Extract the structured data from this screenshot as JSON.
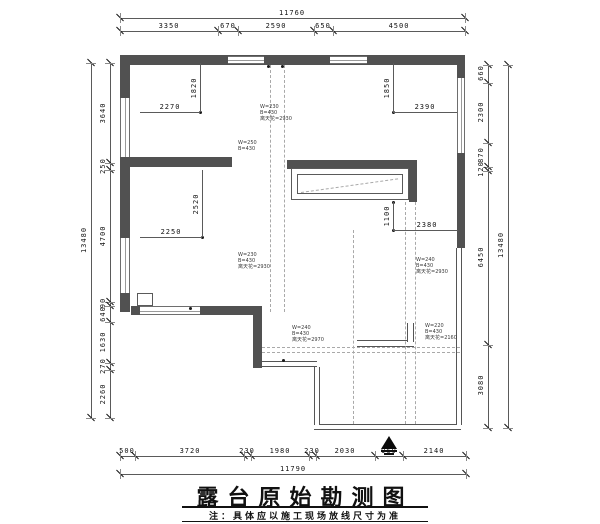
{
  "title": {
    "text": "露台原始勘测图",
    "note": "注：具体应以施工现场放线尺寸为准"
  },
  "drawing": {
    "dimension_chains": {
      "top": {
        "total": "11760",
        "segments": [
          "3350",
          "670",
          "2590",
          "650",
          "4500"
        ]
      },
      "bottom": {
        "total": "11790",
        "segments": [
          "500",
          "3720",
          "230",
          "1980",
          "230",
          "2030",
          "960",
          "2140"
        ]
      },
      "left": {
        "total": "13480",
        "segments": [
          "3640",
          "250",
          "4700",
          "90",
          "640",
          "1630",
          "270",
          "2260"
        ]
      },
      "right": {
        "total": "13480",
        "segments": [
          "660",
          "2300",
          "870",
          "120",
          "6450",
          "3080"
        ]
      }
    },
    "strips": [
      {
        "n": "dim-top-total",
        "dir": "h",
        "pos": 18,
        "from": 120,
        "to": 465,
        "ticks": [
          120,
          465
        ],
        "labels": [
          {
            "t": "11760",
            "c": 292
          }
        ]
      },
      {
        "n": "dim-top-segments",
        "dir": "h",
        "pos": 31,
        "from": 120,
        "to": 465,
        "ticks": [
          120,
          218,
          238,
          314,
          333,
          465
        ],
        "labels": [
          {
            "t": "3350",
            "c": 169
          },
          {
            "t": "670",
            "c": 228
          },
          {
            "t": "2590",
            "c": 276
          },
          {
            "t": "650",
            "c": 323
          },
          {
            "t": "4500",
            "c": 399
          }
        ]
      },
      {
        "n": "dim-bottom-segments",
        "dir": "h",
        "pos": 456,
        "from": 120,
        "to": 466,
        "ticks": [
          120,
          135,
          244,
          251,
          309,
          316,
          375,
          403,
          466
        ],
        "labels": [
          {
            "t": "500",
            "c": 127
          },
          {
            "t": "3720",
            "c": 190
          },
          {
            "t": "230",
            "c": 247
          },
          {
            "t": "1980",
            "c": 280
          },
          {
            "t": "230",
            "c": 312
          },
          {
            "t": "2030",
            "c": 345
          },
          {
            "t": "960",
            "c": 389
          },
          {
            "t": "2140",
            "c": 434
          }
        ]
      },
      {
        "n": "dim-bottom-total",
        "dir": "h",
        "pos": 474,
        "from": 120,
        "to": 466,
        "ticks": [
          120,
          466
        ],
        "labels": [
          {
            "t": "11790",
            "c": 293
          }
        ]
      },
      {
        "n": "dim-left-segments",
        "dir": "v",
        "pos": 110,
        "from": 63,
        "to": 418,
        "ticks": [
          63,
          163,
          170,
          302,
          306,
          322,
          363,
          370,
          418
        ],
        "labels": [
          {
            "t": "3640",
            "c": 113
          },
          {
            "t": "250",
            "c": 166
          },
          {
            "t": "4700",
            "c": 236
          },
          {
            "t": "90",
            "c": 303
          },
          {
            "t": "640",
            "c": 314
          },
          {
            "t": "1630",
            "c": 342
          },
          {
            "t": "270",
            "c": 366
          },
          {
            "t": "2260",
            "c": 394
          }
        ]
      },
      {
        "n": "dim-left-total",
        "dir": "v",
        "pos": 91,
        "from": 63,
        "to": 418,
        "ticks": [
          63,
          418
        ],
        "labels": [
          {
            "t": "13480",
            "c": 240
          }
        ]
      },
      {
        "n": "dim-right-segments",
        "dir": "v",
        "pos": 488,
        "from": 65,
        "to": 428,
        "ticks": [
          65,
          83,
          143,
          167,
          171,
          345,
          428
        ],
        "labels": [
          {
            "t": "660",
            "c": 73
          },
          {
            "t": "2300",
            "c": 112
          },
          {
            "t": "870",
            "c": 155
          },
          {
            "t": "120",
            "c": 169
          },
          {
            "t": "6450",
            "c": 257
          },
          {
            "t": "3080",
            "c": 385
          }
        ]
      },
      {
        "n": "dim-right-total",
        "dir": "v",
        "pos": 508,
        "from": 65,
        "to": 428,
        "ticks": [
          65,
          428
        ],
        "labels": [
          {
            "t": "13480",
            "c": 245
          }
        ]
      }
    ],
    "inner_dims": [
      {
        "dir": "h",
        "x": 140,
        "y": 112,
        "len": 60,
        "label": "2270",
        "lc": [
          170,
          103
        ]
      },
      {
        "dir": "v",
        "x": 200,
        "y": 63,
        "len": 49,
        "label": "1820",
        "lc": [
          194,
          88
        ]
      },
      {
        "dir": "h",
        "x": 393,
        "y": 112,
        "len": 64,
        "label": "2390",
        "lc": [
          425,
          103
        ]
      },
      {
        "dir": "v",
        "x": 393,
        "y": 63,
        "len": 49,
        "label": "1850",
        "lc": [
          387,
          88
        ]
      },
      {
        "dir": "h",
        "x": 140,
        "y": 237,
        "len": 62,
        "label": "2250",
        "lc": [
          171,
          228
        ]
      },
      {
        "dir": "v",
        "x": 202,
        "y": 170,
        "len": 67,
        "label": "2520",
        "lc": [
          196,
          204
        ]
      },
      {
        "dir": "h",
        "x": 393,
        "y": 230,
        "len": 65,
        "label": "2380",
        "lc": [
          427,
          221
        ]
      },
      {
        "dir": "v",
        "x": 393,
        "y": 202,
        "len": 28,
        "label": "1100",
        "lc": [
          387,
          216
        ]
      }
    ],
    "annotations": [
      {
        "x": 260,
        "y": 104,
        "lines": [
          "W=230",
          "B=430",
          "离天花=2930"
        ]
      },
      {
        "x": 238,
        "y": 140,
        "lines": [
          "W=250",
          "B=430"
        ]
      },
      {
        "x": 238,
        "y": 252,
        "lines": [
          "W=230",
          "B=430",
          "离天花=2930"
        ]
      },
      {
        "x": 416,
        "y": 257,
        "lines": [
          "W=240",
          "B=430",
          "离天花=2930"
        ]
      },
      {
        "x": 292,
        "y": 325,
        "lines": [
          "W=240",
          "B=430",
          "离天花=2970"
        ]
      },
      {
        "x": 425,
        "y": 323,
        "lines": [
          "W=220",
          "B=430",
          "离天花=2160"
        ]
      }
    ],
    "walls": [
      [
        120,
        55,
        345,
        10
      ],
      [
        120,
        55,
        10,
        257
      ],
      [
        457,
        55,
        8,
        193
      ],
      [
        120,
        157,
        112,
        10
      ],
      [
        287,
        160,
        130,
        9
      ],
      [
        409,
        169,
        8,
        33
      ],
      [
        131,
        306,
        9,
        9
      ],
      [
        200,
        306,
        62,
        9
      ],
      [
        253,
        315,
        9,
        53
      ]
    ],
    "windows_h": [
      [
        228,
        56,
        36,
        8
      ],
      [
        330,
        56,
        37,
        8
      ],
      [
        140,
        306,
        60,
        9
      ]
    ],
    "windows_v": [
      [
        120,
        98,
        10,
        59
      ],
      [
        120,
        238,
        10,
        55
      ],
      [
        457,
        78,
        8,
        75
      ]
    ],
    "rails_h": [
      [
        262,
        361,
        55,
        6
      ],
      [
        314,
        424,
        147,
        6
      ],
      [
        357,
        340,
        57,
        7
      ]
    ],
    "rails_v": [
      [
        314,
        367,
        6,
        58
      ],
      [
        456,
        248,
        6,
        177
      ],
      [
        407,
        323,
        7,
        19
      ]
    ],
    "outlines": [
      [
        291,
        168,
        118,
        32
      ],
      [
        297,
        174,
        106,
        20
      ],
      [
        137,
        293,
        16,
        13
      ]
    ],
    "dash_v": [
      [
        270,
        65,
        247
      ],
      [
        284,
        65,
        247
      ],
      [
        405,
        202,
        222
      ],
      [
        415,
        202,
        222
      ],
      [
        353,
        230,
        194
      ]
    ],
    "dash_h": [
      [
        262,
        347,
        198
      ],
      [
        262,
        352,
        198
      ]
    ],
    "dash_diag": [
      {
        "x": 301,
        "y": 192,
        "len": 98,
        "deg": -8
      }
    ],
    "dots": [
      [
        200,
        112
      ],
      [
        202,
        237
      ],
      [
        393,
        112
      ],
      [
        393,
        202
      ],
      [
        393,
        230
      ],
      [
        268,
        66
      ],
      [
        282,
        66
      ],
      [
        283,
        360
      ],
      [
        190,
        308
      ]
    ],
    "entry_arrow": {
      "x": 389,
      "y": 436,
      "bars": [
        [
          381,
          450,
          16,
          2
        ],
        [
          384,
          453,
          10,
          2
        ]
      ]
    }
  }
}
